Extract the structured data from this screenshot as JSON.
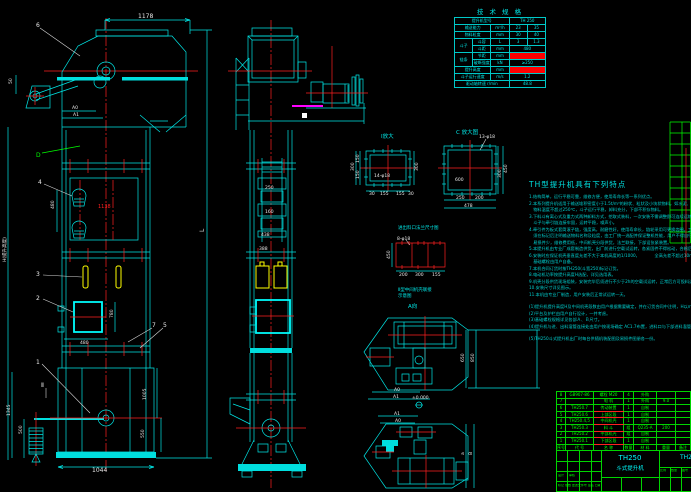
{
  "colors": {
    "cyan": "#00e6e6",
    "green": "#00ff00",
    "red": "#ff2020",
    "yellow": "#ffff00",
    "magenta": "#ff00ff",
    "white": "#ffffff",
    "background": "#000000"
  },
  "spec": {
    "title": "技 术 规 格",
    "model_label": "提升机型号",
    "model_value": "TH 250",
    "capacity_label": "输送能力",
    "capacity_unit": "m³/h",
    "capacity_v1": "23",
    "capacity_v2": "35",
    "size_label": "物料粒度",
    "size_unit": "mm",
    "size_v1": "30",
    "size_v2": "40",
    "bucket_label": "斗子",
    "vol_label": "斗容",
    "vol_unit": "L",
    "vol_v1": "3",
    "vol_v2": "1.3",
    "pitch_label": "斗距",
    "pitch_unit": "mm",
    "pitch_value": "480",
    "chain_label": "链条",
    "chainpitch_label": "节距",
    "chainpitch_unit": "mm",
    "break_label": "破断强度",
    "break_unit": "kN",
    "break_value": "≥250",
    "height_label": "提升高度",
    "height_unit": "mm",
    "speed_label": "斗子运行速度",
    "speed_unit": "m/s",
    "speed_value": "1.2",
    "rpm_label": "驱动轴转速 r/min",
    "rpm_value": "48.8"
  },
  "notes": {
    "title": "TH型提升机具有下列特点",
    "lines": [
      "1.结构简单，运行平稳可靠，维修方便，使用寿命长等一系列优点。",
      "2.本系列提升机适用于输送堆积密度小于1.5t/m³的粉状、粒状及小块状物料，如水泥、碎石、砂、化肥、粮食等。",
      "　物料温度不超过250℃，斗子运行平稳，卸料充分，下部不积存物料。",
      "3.下料斗有离心式及重力式两种卸料方式，挖取式装料，一次安装不需调整即可连续运转，故障少，容易维修。",
      "　斗子与牵引链连接牢固，运转平稳，噪声小。",
      "4.牵引件为板式套筒滚子链，强度高，耐磨性好，使用寿命长，链轮采用可更换齿圈，工厂成批生产制造，用户订货时，",
      "　须在标记后注明输送物料名称及粒度，由工厂统一选配并保证整机性能，用户不得自行更换，头轮与底轮中心距按需要确定，",
      "　易损件少，维修费用低，中间机壳分段供货，法兰联接，下部设张紧装置。",
      "5.本提升机由专业厂成套制造供货，出厂前进行空载试运转，各紧固件不得松动，合格后方可出厂。",
      "6.安装时应保证机壳垂直度允差不大于本机高度的1/1000，　　　　全高允差不超过10mm。",
      "　基础螺栓由用户自备。",
      "7.本机合同订货时按TH250(斗宽250)标记订货。",
      "8.电动机功率按提升高度H选配，详见选用表。",
      "9.机壳分段供货现场组装，安装完毕后须进行不少于2h的空载试运转，正常后方可投料运转，其余详见使用说明书。",
      "10.安装尺寸详见图示。",
      "11.本机由专业厂制造，用户安装后正常试运转一天。",
      "(1)提升机提升高度H及中间机壳段数由用户根据需要确定，并在订货合同中注明，H以m计，中间机壳每段长2.5m。",
      "(2)平台及护栏由用户自行设计，一并考虑。",
      "(3)基础螺栓规格详见各部Ａ、Ｂ尺寸。",
      "(4)提升机与进、出料溜管连接处由用户按现场确定 AC1.7布置，进料口与下部进料溜管以斜支承。",
      "(5)TH250斗式提升机出厂时每台供随机装配图及易损件图册各一份。"
    ]
  },
  "bom": {
    "headers": [
      "序号",
      "代  号",
      "名  称",
      "数量",
      "材 料",
      "重量",
      "备注"
    ],
    "rows": [
      {
        "no": "8",
        "code": "GB907-86",
        "name": "螺栓 M20",
        "qty": "4",
        "mat": "外购",
        "wt": "",
        "note": ""
      },
      {
        "no": "7",
        "code": "",
        "name": "电  机",
        "qty": "1",
        "mat": "外购",
        "wt": "9.0",
        "note": ""
      },
      {
        "no": "6",
        "code": "TH250.7",
        "name": "传动装置",
        "qty": "1",
        "mat": "自制",
        "wt": "",
        "note": ""
      },
      {
        "no": "5",
        "code": "TH250.6",
        "name": "上部区段",
        "qty": "1",
        "mat": "自制",
        "wt": "",
        "note": ""
      },
      {
        "no": "4",
        "code": "TH250.4,5",
        "name": "中间机壳",
        "qty": "1",
        "mat": "自制",
        "wt": "",
        "note": ""
      },
      {
        "no": "3",
        "code": "TH250.3",
        "name": "料  斗",
        "qty": "组",
        "mat": "Q235-A",
        "wt": "200",
        "note": ""
      },
      {
        "no": "2",
        "code": "TH250.2",
        "name": "中部机壳",
        "qty": "组",
        "mat": "自制",
        "wt": "",
        "note": ""
      },
      {
        "no": "1",
        "code": "TH250.1",
        "name": "下部区段",
        "qty": "1",
        "mat": "自制",
        "wt": "",
        "note": ""
      }
    ]
  },
  "title_block": {
    "model": "TH250",
    "name": "斗式提升机",
    "drawing_no": "TH250",
    "scale_label": "比例",
    "qty_label": "数量",
    "sheet_label": "图号",
    "mark_row": "标记 处数 更改文件号 签名 日期",
    "design": "设计",
    "check": "审核"
  },
  "t": {
    "n1": "1",
    "n2": "2",
    "n3": "3",
    "n4": "4",
    "n5": "5",
    "n6": "6",
    "n7": "7",
    "sII": "Ⅱ",
    "sD": "D",
    "sL": "L",
    "d1178": "1178",
    "a0": "A0",
    "a1": "A1",
    "d50": "50",
    "d480": "480",
    "d1138": "1138",
    "d780": "780",
    "d480b": "480",
    "d1044": "1044",
    "dH": "H(提升高度)",
    "d1345": "1345",
    "d500": "500",
    "d1005": "1005",
    "d550": "550",
    "m250": "250",
    "m160": "160",
    "m438": "438",
    "m388": "388",
    "detI": "Ⅰ放大",
    "detC": "C 放大图",
    "b13": "13-φ18",
    "b14": "14-φ18",
    "b8": "8-φ18",
    "f300l": "300",
    "f150a": "150",
    "f150b": "150",
    "f30a": "30",
    "f155a": "155",
    "f155b": "155",
    "f30b": "30",
    "f300r": "300",
    "c600": "600",
    "c450": "450",
    "c300": "300",
    "c250": "250",
    "c200": "200",
    "c478": "478",
    "r450": "450",
    "r200": "200",
    "r300": "300",
    "r155": "155",
    "cap": "进出料口法兰尺寸图",
    "sch1": "Ⅱ型中间机壳联接",
    "sch2": "示意图",
    "av": "A向",
    "p650": "650",
    "p850": "850",
    "pa0": "A0",
    "pa1": "A1",
    "pz": "±0.000",
    "qa1": "A1",
    "qa0": "A0",
    "qB": "B",
    "qa": "a"
  }
}
